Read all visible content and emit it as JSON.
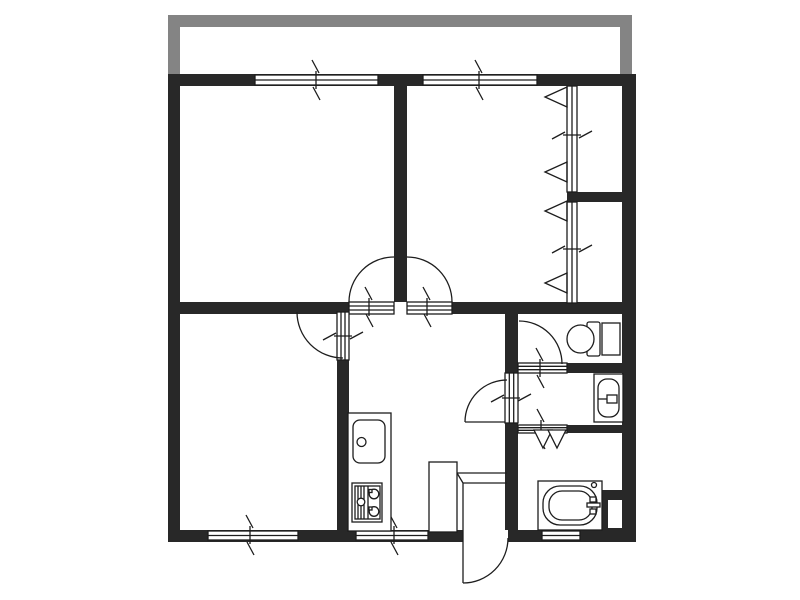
{
  "document": {
    "kind": "apartment-floor-plan",
    "width": 800,
    "height": 600
  },
  "colors": {
    "wall": "#282828",
    "line": "#1d1d1d",
    "balcony": "#848484",
    "white": "#ffffff"
  },
  "shapes": [
    {
      "name": "balcony-rail-left",
      "type": "rect",
      "x": 168,
      "y": 15,
      "w": 12,
      "h": 60,
      "fill": "balcony"
    },
    {
      "name": "balcony-rail-top",
      "type": "rect",
      "x": 168,
      "y": 15,
      "w": 464,
      "h": 12,
      "fill": "balcony"
    },
    {
      "name": "balcony-rail-right",
      "type": "rect",
      "x": 620,
      "y": 15,
      "w": 12,
      "h": 60,
      "fill": "balcony"
    },
    {
      "name": "wall-outer-top",
      "type": "rect",
      "x": 168,
      "y": 74,
      "w": 468,
      "h": 12,
      "fill": "wall"
    },
    {
      "name": "wall-outer-left",
      "type": "rect",
      "x": 168,
      "y": 74,
      "w": 12,
      "h": 468,
      "fill": "wall"
    },
    {
      "name": "wall-outer-right",
      "type": "rect",
      "x": 622,
      "y": 74,
      "w": 14,
      "h": 468,
      "fill": "wall"
    },
    {
      "name": "wall-outer-bottom",
      "type": "rect",
      "x": 168,
      "y": 530,
      "w": 468,
      "h": 12,
      "fill": "wall"
    },
    {
      "name": "wall-bedroom-divider",
      "type": "rect",
      "x": 394,
      "y": 86,
      "w": 13,
      "h": 216,
      "fill": "wall"
    },
    {
      "name": "wall-hall-upper-left",
      "type": "rect",
      "x": 180,
      "y": 302,
      "w": 169,
      "h": 12,
      "fill": "wall"
    },
    {
      "name": "wall-hall-upper-right",
      "type": "rect",
      "x": 452,
      "y": 302,
      "w": 170,
      "h": 12,
      "fill": "wall"
    },
    {
      "name": "wall-living-kitchen",
      "type": "rect",
      "x": 337,
      "y": 312,
      "w": 12,
      "h": 218,
      "fill": "wall"
    },
    {
      "name": "wall-kitchen-wetarea",
      "type": "rect",
      "x": 505,
      "y": 302,
      "w": 13,
      "h": 240,
      "fill": "wall"
    },
    {
      "name": "wall-toilet-south",
      "type": "rect",
      "x": 518,
      "y": 363,
      "w": 104,
      "h": 10,
      "fill": "wall"
    },
    {
      "name": "wall-washroom-south",
      "type": "rect",
      "x": 518,
      "y": 425,
      "w": 104,
      "h": 8,
      "fill": "wall"
    },
    {
      "name": "wall-window-stub",
      "type": "rect",
      "x": 567,
      "y": 192,
      "w": 55,
      "h": 10,
      "fill": "wall"
    },
    {
      "name": "pipe-space-block",
      "type": "rect",
      "x": 598,
      "y": 490,
      "w": 24,
      "h": 50,
      "fill": "wall"
    },
    {
      "name": "pipe-space-notch",
      "type": "rect",
      "x": 608,
      "y": 500,
      "w": 14,
      "h": 28,
      "fill": "white"
    },
    {
      "name": "window-top-left",
      "type": "rect",
      "x": 255,
      "y": 75,
      "w": 123,
      "h": 10,
      "fill": "white",
      "stroke": "line"
    },
    {
      "name": "window-top-left-mullion",
      "type": "line",
      "x1": 255,
      "y1": 80,
      "x2": 378,
      "y2": 80,
      "stroke": "line"
    },
    {
      "name": "window-top-right",
      "type": "rect",
      "x": 423,
      "y": 75,
      "w": 114,
      "h": 10,
      "fill": "white",
      "stroke": "line"
    },
    {
      "name": "window-top-right-mullion",
      "type": "line",
      "x1": 423,
      "y1": 80,
      "x2": 537,
      "y2": 80,
      "stroke": "line"
    },
    {
      "name": "window-bottom-left",
      "type": "rect",
      "x": 208,
      "y": 531,
      "w": 90,
      "h": 9,
      "fill": "white",
      "stroke": "line"
    },
    {
      "name": "window-bottom-left-mullion",
      "type": "line",
      "x1": 208,
      "y1": 535.5,
      "x2": 298,
      "y2": 535.5,
      "stroke": "line"
    },
    {
      "name": "window-bottom-kitchen",
      "type": "rect",
      "x": 356,
      "y": 531,
      "w": 72,
      "h": 9,
      "fill": "white",
      "stroke": "line"
    },
    {
      "name": "window-bottom-kitchen-mullion",
      "type": "line",
      "x1": 356,
      "y1": 535.5,
      "x2": 428,
      "y2": 535.5,
      "stroke": "line"
    },
    {
      "name": "window-bottom-bath",
      "type": "rect",
      "x": 542,
      "y": 531,
      "w": 38,
      "h": 9,
      "fill": "white",
      "stroke": "line"
    },
    {
      "name": "window-bottom-bath-mullion",
      "type": "line",
      "x1": 542,
      "y1": 535.5,
      "x2": 580,
      "y2": 535.5,
      "stroke": "line"
    },
    {
      "name": "window-right-upper",
      "type": "rect",
      "x": 567,
      "y": 86,
      "w": 10,
      "h": 106,
      "fill": "white",
      "stroke": "line"
    },
    {
      "name": "window-right-upper-mullion",
      "type": "line",
      "x1": 572,
      "y1": 86,
      "x2": 572,
      "y2": 192,
      "stroke": "line"
    },
    {
      "name": "window-right-lower",
      "type": "rect",
      "x": 567,
      "y": 202,
      "w": 10,
      "h": 101,
      "fill": "white",
      "stroke": "line"
    },
    {
      "name": "window-right-lower-mullion",
      "type": "line",
      "x1": 572,
      "y1": 202,
      "x2": 572,
      "y2": 303,
      "stroke": "line"
    },
    {
      "name": "doorway-bedroom1",
      "type": "rect",
      "x": 349,
      "y": 302,
      "w": 45,
      "h": 12,
      "fill": "white",
      "stroke": "line"
    },
    {
      "name": "doorway-bedroom1-line1",
      "type": "line",
      "x1": 349,
      "y1": 306,
      "x2": 394,
      "y2": 306,
      "stroke": "line"
    },
    {
      "name": "doorway-bedroom1-line2",
      "type": "line",
      "x1": 349,
      "y1": 310,
      "x2": 394,
      "y2": 310,
      "stroke": "line"
    },
    {
      "name": "doorway-bedroom2",
      "type": "rect",
      "x": 407,
      "y": 302,
      "w": 45,
      "h": 12,
      "fill": "white",
      "stroke": "line"
    },
    {
      "name": "doorway-bedroom2-line1",
      "type": "line",
      "x1": 407,
      "y1": 306,
      "x2": 452,
      "y2": 306,
      "stroke": "line"
    },
    {
      "name": "doorway-bedroom2-line2",
      "type": "line",
      "x1": 407,
      "y1": 310,
      "x2": 452,
      "y2": 310,
      "stroke": "line"
    },
    {
      "name": "doorway-living",
      "type": "rect",
      "x": 337,
      "y": 312,
      "w": 12,
      "h": 48,
      "fill": "white",
      "stroke": "line"
    },
    {
      "name": "doorway-living-line1",
      "type": "line",
      "x1": 341,
      "y1": 312,
      "x2": 341,
      "y2": 360,
      "stroke": "line"
    },
    {
      "name": "doorway-living-line2",
      "type": "line",
      "x1": 345,
      "y1": 312,
      "x2": 345,
      "y2": 360,
      "stroke": "line"
    },
    {
      "name": "doorway-washroom",
      "type": "rect",
      "x": 505,
      "y": 373,
      "w": 13,
      "h": 50,
      "fill": "white",
      "stroke": "line"
    },
    {
      "name": "doorway-washroom-line1",
      "type": "line",
      "x1": 509.3,
      "y1": 373,
      "x2": 509.3,
      "y2": 423,
      "stroke": "line"
    },
    {
      "name": "doorway-washroom-line2",
      "type": "line",
      "x1": 513.7,
      "y1": 373,
      "x2": 513.7,
      "y2": 423,
      "stroke": "line"
    },
    {
      "name": "doorway-toilet",
      "type": "rect",
      "x": 518,
      "y": 363,
      "w": 49,
      "h": 10,
      "fill": "white",
      "stroke": "line"
    },
    {
      "name": "doorway-toilet-line1",
      "type": "line",
      "x1": 518,
      "y1": 366.3,
      "x2": 567,
      "y2": 366.3,
      "stroke": "line"
    },
    {
      "name": "doorway-toilet-line2",
      "type": "line",
      "x1": 518,
      "y1": 369.7,
      "x2": 567,
      "y2": 369.7,
      "stroke": "line"
    },
    {
      "name": "doorway-bathroom",
      "type": "rect",
      "x": 518,
      "y": 425,
      "w": 49,
      "h": 8,
      "fill": "white",
      "stroke": "line"
    },
    {
      "name": "doorway-bathroom-line1",
      "type": "line",
      "x1": 518,
      "y1": 427.7,
      "x2": 567,
      "y2": 427.7,
      "stroke": "line"
    },
    {
      "name": "doorway-bathroom-line2",
      "type": "line",
      "x1": 518,
      "y1": 430.3,
      "x2": 567,
      "y2": 430.3,
      "stroke": "line"
    },
    {
      "name": "entrance-opening",
      "type": "rect",
      "x": 463,
      "y": 530,
      "w": 45,
      "h": 12,
      "fill": "white"
    },
    {
      "name": "door-arc-bedroom1",
      "type": "path",
      "d": "M349,302 A45,45 0 0 1 394,257",
      "stroke": "line"
    },
    {
      "name": "door-arc-bedroom2",
      "type": "path",
      "d": "M407,257 A45,45 0 0 1 452,302",
      "stroke": "line"
    },
    {
      "name": "door-arc-living",
      "type": "path",
      "d": "M297,312 A46,46 0 0 0 343,358",
      "stroke": "line"
    },
    {
      "name": "door-arc-washroom",
      "type": "path",
      "d": "M465,422 A42,42 0 0 1 507,380",
      "stroke": "line"
    },
    {
      "name": "door-leaf-washroom",
      "type": "line",
      "x1": 465,
      "y1": 422,
      "x2": 505,
      "y2": 422,
      "stroke": "line"
    },
    {
      "name": "door-arc-toilet",
      "type": "path",
      "d": "M519,321 A43,43 0 0 1 562,364",
      "stroke": "line"
    },
    {
      "name": "door-arc-entrance",
      "type": "path",
      "d": "M463,583 A45,45 0 0 0 508,538",
      "stroke": "line"
    },
    {
      "name": "door-leaf-entrance",
      "type": "line",
      "x1": 463,
      "y1": 530,
      "x2": 463,
      "y2": 583,
      "stroke": "line"
    },
    {
      "name": "break-mark-window-top-left",
      "type": "path",
      "d": "M312,60 L319,73 M316,71 L316,89 M313,87 L320,100",
      "stroke": "line"
    },
    {
      "name": "break-mark-window-top-right",
      "type": "path",
      "d": "M475,60 L482,73 M479,71 L479,89 M476,87 L483,100",
      "stroke": "line"
    },
    {
      "name": "break-mark-window-bottom-left",
      "type": "path",
      "d": "M246,515 L253,528 M250,526 L250,544 M247,542 L254,555",
      "stroke": "line"
    },
    {
      "name": "break-mark-window-kitchen",
      "type": "path",
      "d": "M390,515 L397,528 M394,526 L394,544 M391,542 L398,555",
      "stroke": "line"
    },
    {
      "name": "break-mark-doorway-bedroom1",
      "type": "path",
      "d": "M365,287 L372,300 M369,298 L369,316 M366,314 L373,327",
      "stroke": "line"
    },
    {
      "name": "break-mark-doorway-bedroom2",
      "type": "path",
      "d": "M423,287 L430,300 M427,298 L427,316 M424,314 L431,327",
      "stroke": "line"
    },
    {
      "name": "break-mark-doorway-toilet",
      "type": "path",
      "d": "M536,348 L543,361 M540,359 L540,377 M537,375 L544,388",
      "stroke": "line"
    },
    {
      "name": "break-mark-doorway-bathroom",
      "type": "path",
      "d": "M537,409 L544,422 M541,420 L541,438 M538,436 L545,449",
      "stroke": "line"
    },
    {
      "name": "break-mark-window-right-upper",
      "type": "path",
      "d": "M552,139 L565,132 M563,135 L581,135 M579,138 L592,131",
      "stroke": "line"
    },
    {
      "name": "break-mark-window-right-lower",
      "type": "path",
      "d": "M552,253 L565,246 M563,249 L581,249 M579,252 L592,245",
      "stroke": "line"
    },
    {
      "name": "break-mark-doorway-living",
      "type": "path",
      "d": "M323,340 L336,333 M334,336 L352,336 M350,339 L363,332",
      "stroke": "line"
    },
    {
      "name": "break-mark-doorway-washroom",
      "type": "path",
      "d": "M491,402 L504,395 M502,398 L520,398 M518,401 L531,394",
      "stroke": "line"
    },
    {
      "name": "casement-triangle-1",
      "type": "polygon",
      "points": "545,97 567,87 567,107",
      "fill": "none",
      "stroke": "line"
    },
    {
      "name": "casement-triangle-2",
      "type": "polygon",
      "points": "545,172 567,162 567,182",
      "fill": "none",
      "stroke": "line"
    },
    {
      "name": "casement-triangle-3",
      "type": "polygon",
      "points": "545,211 567,201 567,221",
      "fill": "none",
      "stroke": "line"
    },
    {
      "name": "casement-triangle-4",
      "type": "polygon",
      "points": "545,283 567,273 567,293",
      "fill": "none",
      "stroke": "line"
    },
    {
      "name": "folding-door-left",
      "type": "polygon",
      "points": "534,430 552,430 543,448",
      "fill": "white",
      "stroke": "line"
    },
    {
      "name": "folding-door-right",
      "type": "polygon",
      "points": "548,430 566,430 557,448",
      "fill": "white",
      "stroke": "line"
    },
    {
      "name": "toilet-seat",
      "type": "rect",
      "x": 587,
      "y": 322,
      "w": 13,
      "h": 34,
      "rx": 2,
      "fill": "white",
      "stroke": "line"
    },
    {
      "name": "toilet-tank",
      "type": "rect",
      "x": 602,
      "y": 323,
      "w": 18,
      "h": 32,
      "fill": "white",
      "stroke": "line"
    },
    {
      "name": "toilet-bowl",
      "type": "ellipse",
      "cx": 580.5,
      "cy": 339,
      "rx": 13.5,
      "ry": 14,
      "fill": "white",
      "stroke": "line"
    },
    {
      "name": "washbasin-counter",
      "type": "rect",
      "x": 594,
      "y": 374,
      "w": 29,
      "h": 48,
      "fill": "white",
      "stroke": "line"
    },
    {
      "name": "washbasin-bowl",
      "type": "rect",
      "x": 598,
      "y": 379,
      "w": 21,
      "h": 38,
      "rx": 9,
      "fill": "white",
      "stroke": "line"
    },
    {
      "name": "washbasin-tap-stem",
      "type": "line",
      "x1": 598,
      "y1": 399,
      "x2": 608,
      "y2": 399,
      "stroke": "line"
    },
    {
      "name": "washbasin-tap",
      "type": "rect",
      "x": 607,
      "y": 395,
      "w": 10,
      "h": 8,
      "fill": "white",
      "stroke": "line"
    },
    {
      "name": "bathtub-outer",
      "type": "rect",
      "x": 538,
      "y": 481,
      "w": 64,
      "h": 49,
      "fill": "white",
      "stroke": "line"
    },
    {
      "name": "bathtub-inner",
      "type": "rect",
      "x": 543,
      "y": 486,
      "w": 54,
      "h": 39,
      "rx": 17,
      "fill": "none",
      "stroke": "line"
    },
    {
      "name": "bathtub-basin",
      "type": "rect",
      "x": 549,
      "y": 491,
      "w": 43,
      "h": 29,
      "rx": 13,
      "fill": "none",
      "stroke": "line"
    },
    {
      "name": "bathtub-drain",
      "type": "circle",
      "cx": 594,
      "cy": 485,
      "r": 2.5,
      "fill": "white",
      "stroke": "line"
    },
    {
      "name": "bathtub-tap-bar",
      "type": "rect",
      "x": 587,
      "y": 503,
      "w": 13,
      "h": 4,
      "fill": "white",
      "stroke": "line"
    },
    {
      "name": "bathtub-tap-knob1",
      "type": "rect",
      "x": 590,
      "y": 497,
      "w": 6,
      "h": 5,
      "fill": "white",
      "stroke": "line"
    },
    {
      "name": "bathtub-tap-knob2",
      "type": "rect",
      "x": 590,
      "y": 509,
      "w": 6,
      "h": 5,
      "fill": "white",
      "stroke": "line"
    },
    {
      "name": "kitchen-counter",
      "type": "rect",
      "x": 348,
      "y": 413,
      "w": 43,
      "h": 118,
      "fill": "white",
      "stroke": "line"
    },
    {
      "name": "kitchen-sink",
      "type": "rect",
      "x": 353,
      "y": 420,
      "w": 32,
      "h": 43,
      "rx": 7,
      "fill": "white",
      "stroke": "line"
    },
    {
      "name": "kitchen-sink-tap",
      "type": "circle",
      "cx": 361.5,
      "cy": 442,
      "r": 4.5,
      "fill": "white",
      "stroke": "line"
    },
    {
      "name": "stove-outer",
      "type": "rect",
      "x": 352,
      "y": 483,
      "w": 30,
      "h": 39,
      "fill": "white",
      "stroke": "line"
    },
    {
      "name": "stove-inner",
      "type": "rect",
      "x": 355,
      "y": 486,
      "w": 25,
      "h": 33,
      "fill": "none",
      "stroke": "line"
    },
    {
      "name": "stove-divider",
      "type": "line",
      "x1": 368,
      "y1": 486,
      "x2": 368,
      "y2": 519,
      "stroke": "line"
    },
    {
      "name": "stove-grill-line1",
      "type": "line",
      "x1": 358,
      "y1": 486,
      "x2": 358,
      "y2": 519,
      "stroke": "line"
    },
    {
      "name": "stove-grill-line2",
      "type": "line",
      "x1": 361,
      "y1": 486,
      "x2": 361,
      "y2": 519,
      "stroke": "line"
    },
    {
      "name": "stove-grill-line3",
      "type": "line",
      "x1": 364,
      "y1": 486,
      "x2": 364,
      "y2": 519,
      "stroke": "line"
    },
    {
      "name": "stove-knob",
      "type": "circle",
      "cx": 361,
      "cy": 502,
      "r": 3.8,
      "fill": "white",
      "stroke": "line"
    },
    {
      "name": "stove-burner1",
      "type": "circle",
      "cx": 374,
      "cy": 494,
      "r": 4.8,
      "fill": "white",
      "stroke": "line"
    },
    {
      "name": "stove-burner2",
      "type": "circle",
      "cx": 374,
      "cy": 511.5,
      "r": 4.8,
      "fill": "white",
      "stroke": "line"
    },
    {
      "name": "stove-burner1-mark",
      "type": "rect",
      "x": 369,
      "y": 489.5,
      "w": 3,
      "h": 3,
      "fill": "white",
      "stroke": "line"
    },
    {
      "name": "stove-burner2-mark",
      "type": "rect",
      "x": 369,
      "y": 507,
      "w": 3,
      "h": 3,
      "fill": "white",
      "stroke": "line"
    },
    {
      "name": "shoe-cabinet",
      "type": "rect",
      "x": 429,
      "y": 462,
      "w": 28,
      "h": 70,
      "fill": "white",
      "stroke": "line"
    },
    {
      "name": "entrance-step",
      "type": "path",
      "d": "M457,473 L507,473 M457,473 L463,483 M463,483 L507,483 M463,483 L463,530",
      "stroke": "line"
    }
  ]
}
